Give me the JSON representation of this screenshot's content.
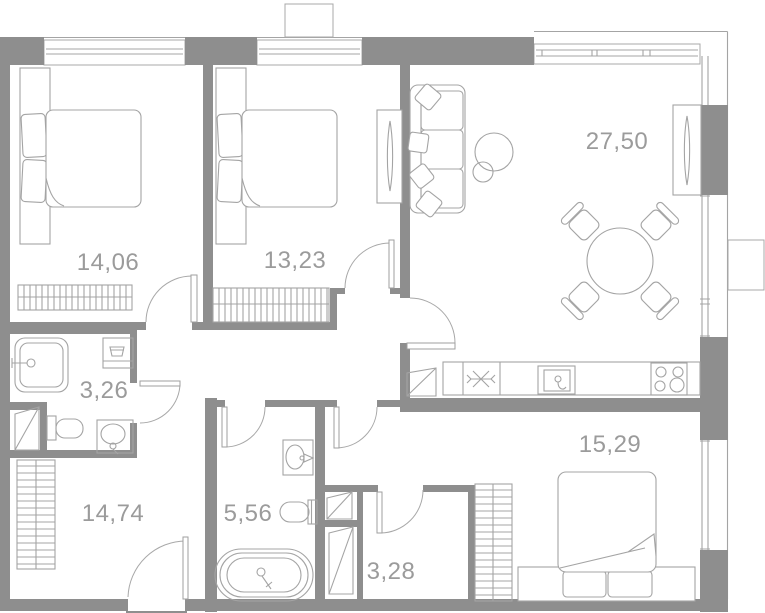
{
  "plan": {
    "background": "#ffffff",
    "wall_color": "#8e8e8e",
    "line_color": "#a4a4a4",
    "label_color": "#9b9b9b",
    "rooms": [
      {
        "id": "bedroom-1",
        "area": "14,06"
      },
      {
        "id": "bedroom-2",
        "area": "13,23"
      },
      {
        "id": "living-kitchen",
        "area": "27,50"
      },
      {
        "id": "bathroom-1",
        "area": "3,26"
      },
      {
        "id": "hallway",
        "area": "14,74"
      },
      {
        "id": "bathroom-2",
        "area": "5,56"
      },
      {
        "id": "storage",
        "area": "3,28"
      },
      {
        "id": "bedroom-3",
        "area": "15,29"
      }
    ],
    "icons": [
      "double-bed-icon",
      "pillow-icon",
      "wardrobe-icon",
      "sofa-icon",
      "floor-lamp-icon",
      "dining-table-icon",
      "chair-icon",
      "radiator-icon",
      "fridge-snowflake-icon",
      "kitchen-sink-icon",
      "stove-burners-icon",
      "shower-tray-icon",
      "washing-machine-icon",
      "toilet-icon",
      "washbasin-icon",
      "bathtub-icon",
      "vent-shaft-icon",
      "door-swing-icon",
      "window-icon",
      "entrance-door-icon"
    ]
  }
}
